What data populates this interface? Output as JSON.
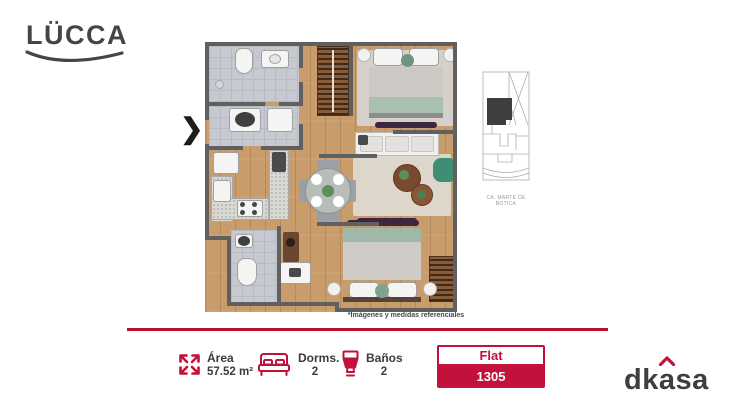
{
  "brand": {
    "logo_text": "LÜCCA"
  },
  "plan": {
    "entrance_marker": "❯"
  },
  "site_map": {
    "caption": "CA. MARTE DE BOTICA"
  },
  "disclaimer": "*Imágenes y medidas referenciales",
  "specs": {
    "area": {
      "label": "Área",
      "value": "57.52 m²"
    },
    "dorms": {
      "label": "Dorms.",
      "value": "2"
    },
    "banos": {
      "label": "Baños",
      "value": "2"
    }
  },
  "unit": {
    "type_label": "Flat",
    "number": "1305"
  },
  "developer": {
    "logo_pre": "dk",
    "logo_accent": "a",
    "logo_post": "sa"
  },
  "icons": {
    "expand": "expand-arrows-icon",
    "bed": "bed-icon",
    "toilet": "toilet-icon"
  },
  "colors": {
    "accent": "#C2123B",
    "wall": "#606060",
    "floor_wood": "#C99C6C",
    "text_dark": "#3B3B3B"
  }
}
